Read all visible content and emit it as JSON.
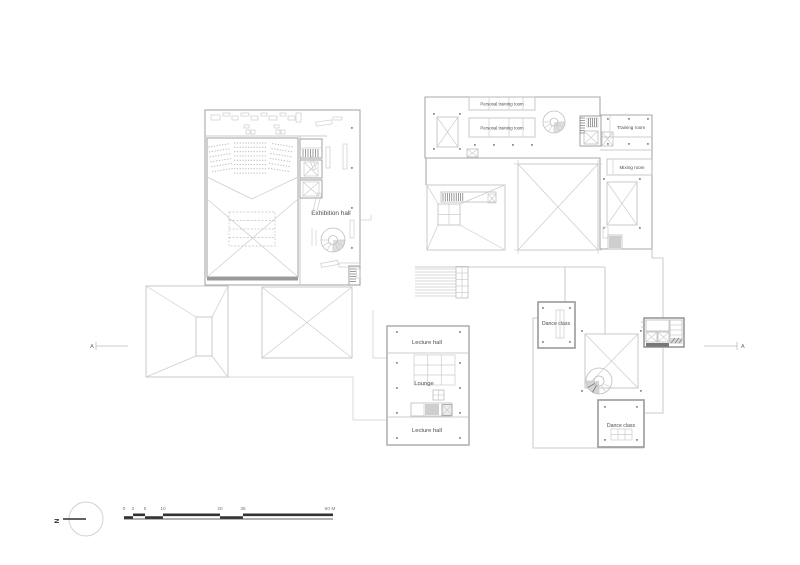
{
  "labels": {
    "exhibition_hall": "Exhibition hall",
    "personal_training_room_a": "Personal training room",
    "personal_training_room_b": "Personal training room",
    "training_room": "Training room",
    "mixing_room": "Mixing room",
    "lecture_hall_upper": "Lecture hall",
    "lounge": "Lounge",
    "lecture_hall_lower": "Lecture hall",
    "dance_class_upper": "Dance class",
    "dance_class_lower": "Dance class"
  },
  "section_markers": {
    "left": "A",
    "right": "A"
  },
  "north_indicator": {
    "label": "N"
  },
  "scale_bar": {
    "ticks": [
      "0",
      "2",
      "5",
      "10",
      "20",
      "35",
      "60 M"
    ]
  },
  "colors": {
    "wall_line": "#a8a8a8",
    "detail_line": "#bdbdbd",
    "dark_detail": "#3a3a3a",
    "label_text": "#4c4c4c",
    "background": "#ffffff"
  }
}
